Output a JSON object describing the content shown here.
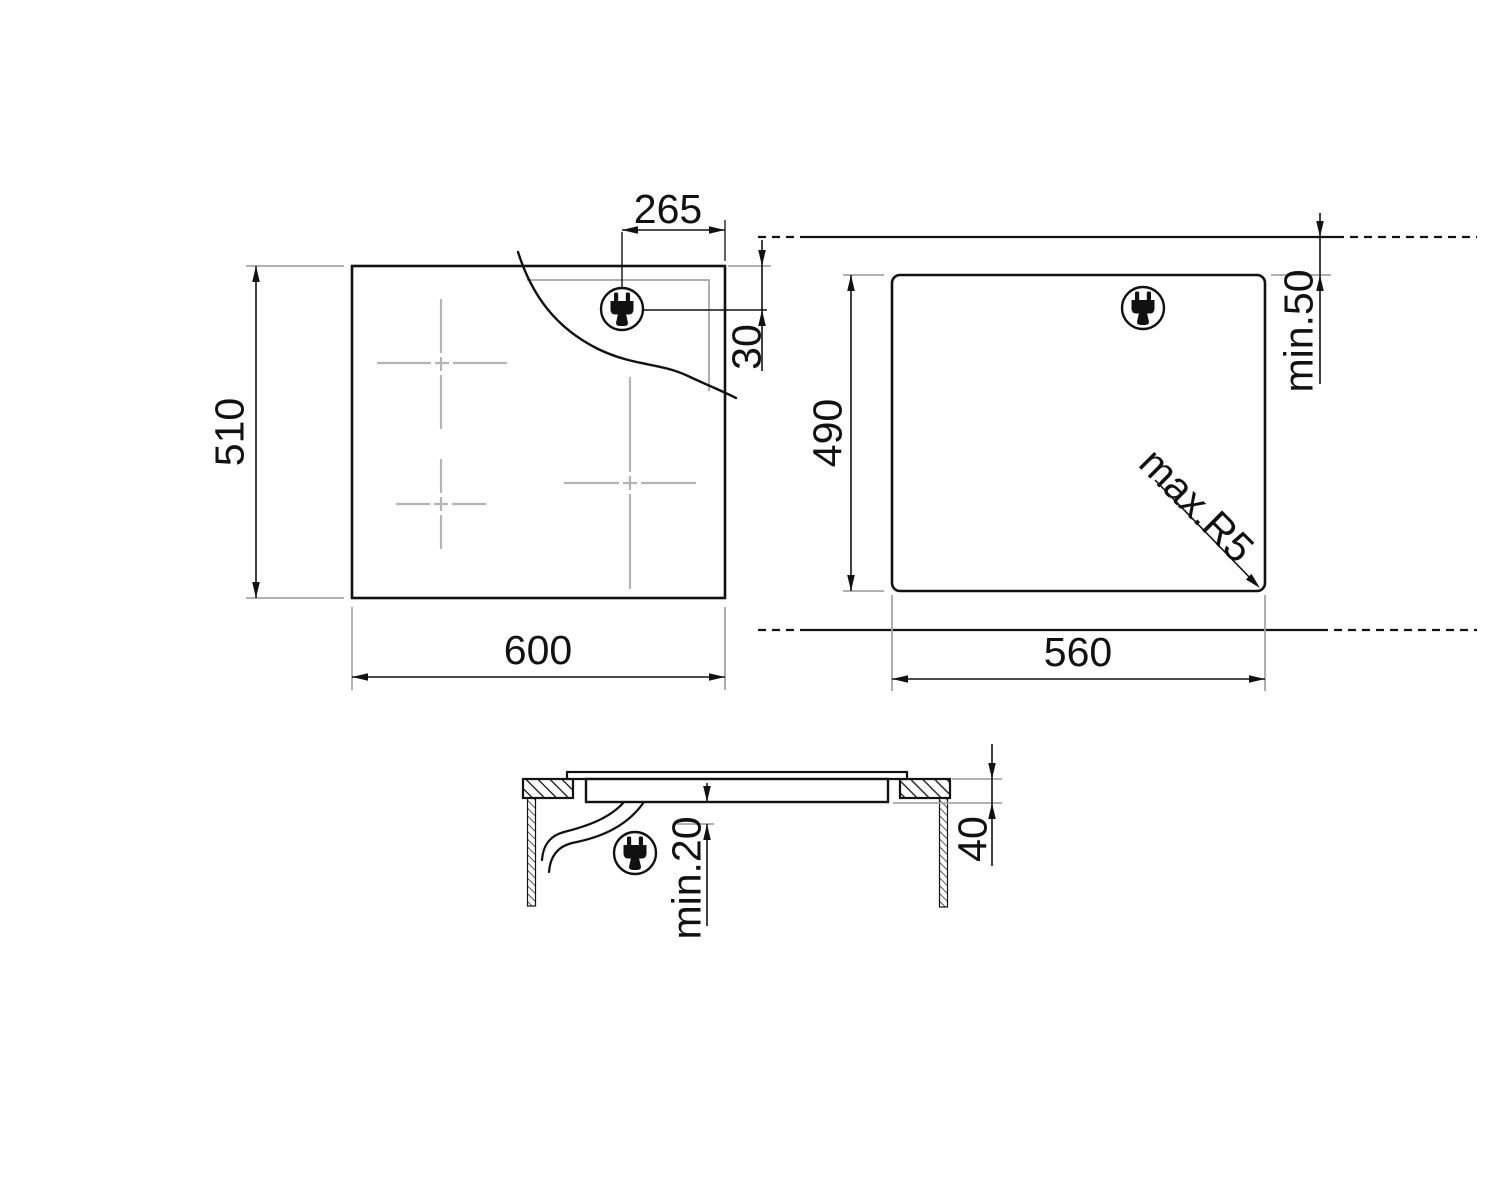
{
  "title": "Hob installation dimension drawing",
  "colors": {
    "line": "#111111",
    "aux_line": "#a6a6a6",
    "centerline": "#b4b4b4",
    "background": "#ffffff"
  },
  "icons": {
    "plug": "power-plug-icon"
  },
  "top_view": {
    "width_label": "600",
    "depth_label": "510",
    "plug_offset_label": "265",
    "plug_drop_label": "30"
  },
  "cutout_view": {
    "width_label": "560",
    "depth_label": "490",
    "back_clearance_label": "min.50",
    "corner_radius_label": "max.R5"
  },
  "section_view": {
    "clearance_label": "min.20",
    "recess_label": "40"
  }
}
